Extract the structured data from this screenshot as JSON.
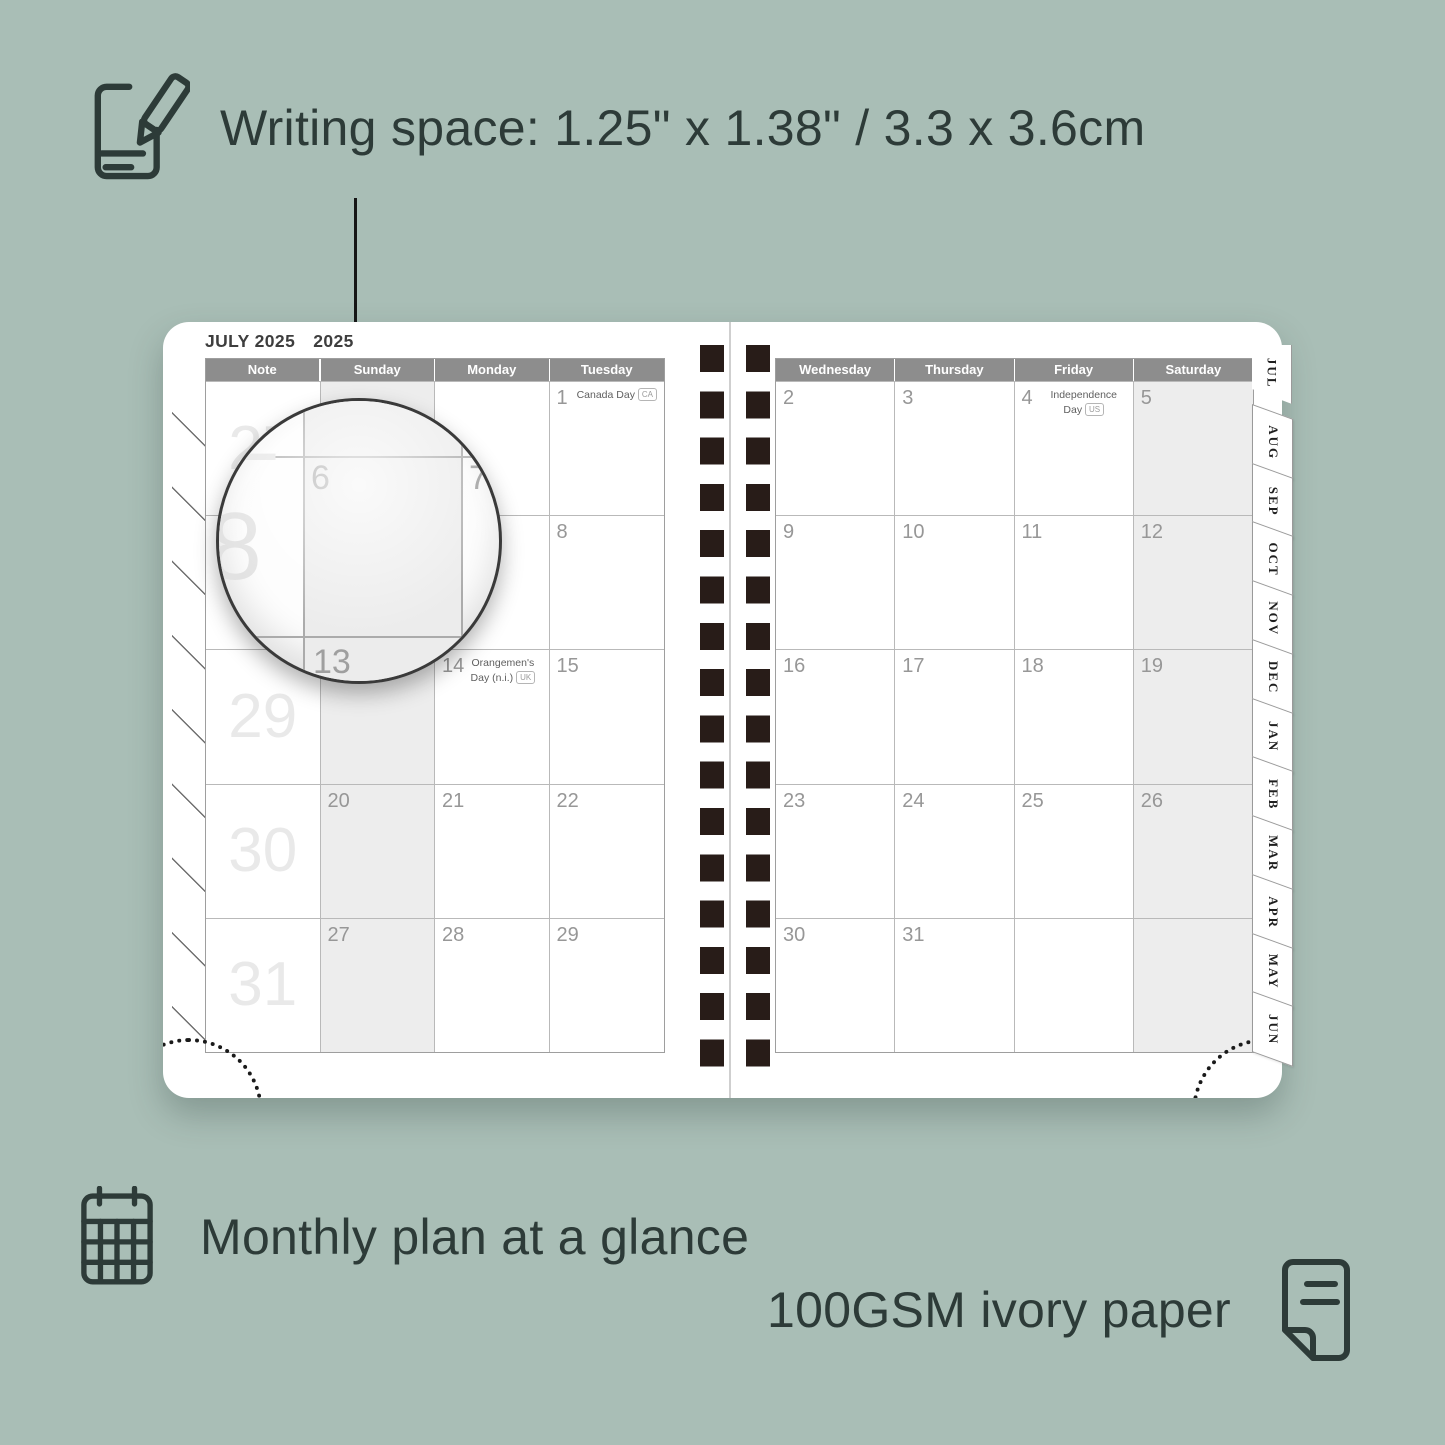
{
  "colors": {
    "background": "#a9beb6",
    "ink": "#2d3b38",
    "header_bar": "#8d8d8d",
    "shaded_column": "#ededed",
    "binding_holes": "#281c18"
  },
  "callouts": {
    "writing_space": "Writing space: 1.25\" x 1.38\" / 3.3 x 3.6cm",
    "monthly_plan": "Monthly plan at a glance",
    "paper": "100GSM ivory paper"
  },
  "planner": {
    "title": "JULY 2025",
    "year": "2025",
    "left_page": {
      "headers": [
        "Note",
        "Sunday",
        "Monday",
        "Tuesday"
      ],
      "week_numbers": [
        "27",
        "28",
        "29",
        "30",
        "31"
      ],
      "rows": [
        [
          {
            "n": ""
          },
          {
            "n": ""
          },
          {
            "n": "1",
            "holiday": "Canada Day",
            "badge": "CA"
          }
        ],
        [
          {
            "n": "6"
          },
          {
            "n": "7"
          },
          {
            "n": "8"
          }
        ],
        [
          {
            "n": "13"
          },
          {
            "n": "14",
            "holiday": "Orangemen's Day (n.i.)",
            "badge": "UK"
          },
          {
            "n": "15"
          }
        ],
        [
          {
            "n": "20"
          },
          {
            "n": "21"
          },
          {
            "n": "22"
          }
        ],
        [
          {
            "n": "27"
          },
          {
            "n": "28"
          },
          {
            "n": "29"
          }
        ]
      ]
    },
    "right_page": {
      "headers": [
        "Wednesday",
        "Thursday",
        "Friday",
        "Saturday"
      ],
      "rows": [
        [
          {
            "n": "2"
          },
          {
            "n": "3"
          },
          {
            "n": "4",
            "holiday": "Independence Day",
            "badge": "US"
          },
          {
            "n": "5"
          }
        ],
        [
          {
            "n": "9"
          },
          {
            "n": "10"
          },
          {
            "n": "11"
          },
          {
            "n": "12"
          }
        ],
        [
          {
            "n": "16"
          },
          {
            "n": "17"
          },
          {
            "n": "18"
          },
          {
            "n": "19"
          }
        ],
        [
          {
            "n": "23"
          },
          {
            "n": "24"
          },
          {
            "n": "25"
          },
          {
            "n": "26"
          }
        ],
        [
          {
            "n": "30"
          },
          {
            "n": "31"
          },
          {
            "n": ""
          },
          {
            "n": ""
          }
        ]
      ]
    },
    "tabs": [
      "JUL",
      "AUG",
      "SEP",
      "OCT",
      "NOV",
      "DEC",
      "JAN",
      "FEB",
      "MAR",
      "APR",
      "MAY",
      "JUN"
    ],
    "magnifier": {
      "week_top": "2",
      "week_left": "28",
      "day": "6",
      "day_right": "7",
      "day_below": "13"
    }
  }
}
